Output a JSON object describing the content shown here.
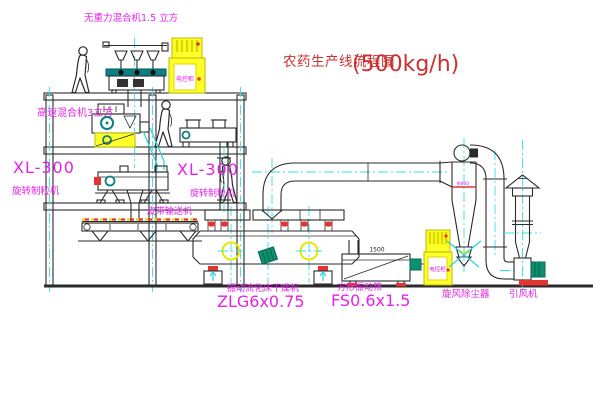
{
  "title": {
    "text": "农药生产线流程图",
    "capacity": "(500kg/h)"
  },
  "labels": {
    "top_mixer": "无重力混合机1.5 立方",
    "hs_mixer": "高速混合机3立方",
    "granulator_model": "XL-300",
    "granulator_name": "旋转制粒机",
    "belt_conveyor": "皮带输送机",
    "dryer_name": "振动流化床干燥机",
    "dryer_model": "ZLG6x0.75",
    "screen_name": "方形振动筛",
    "screen_model": "FS0.6x1.5",
    "cyclone": "旋风除尘器",
    "fan": "引风机",
    "cabinet": "电控柜",
    "cyclone_note": "Φ800",
    "screen_dim": "1500"
  },
  "colors": {
    "label_magenta": "#e820e8",
    "title_red": "#cc3030",
    "line_black": "#2b2b2b",
    "centerline_cyan": "#35dfe8",
    "equipment_yellow": "#ffff29",
    "alert_red": "#e33333",
    "motor_teal": "#0f8f72"
  }
}
